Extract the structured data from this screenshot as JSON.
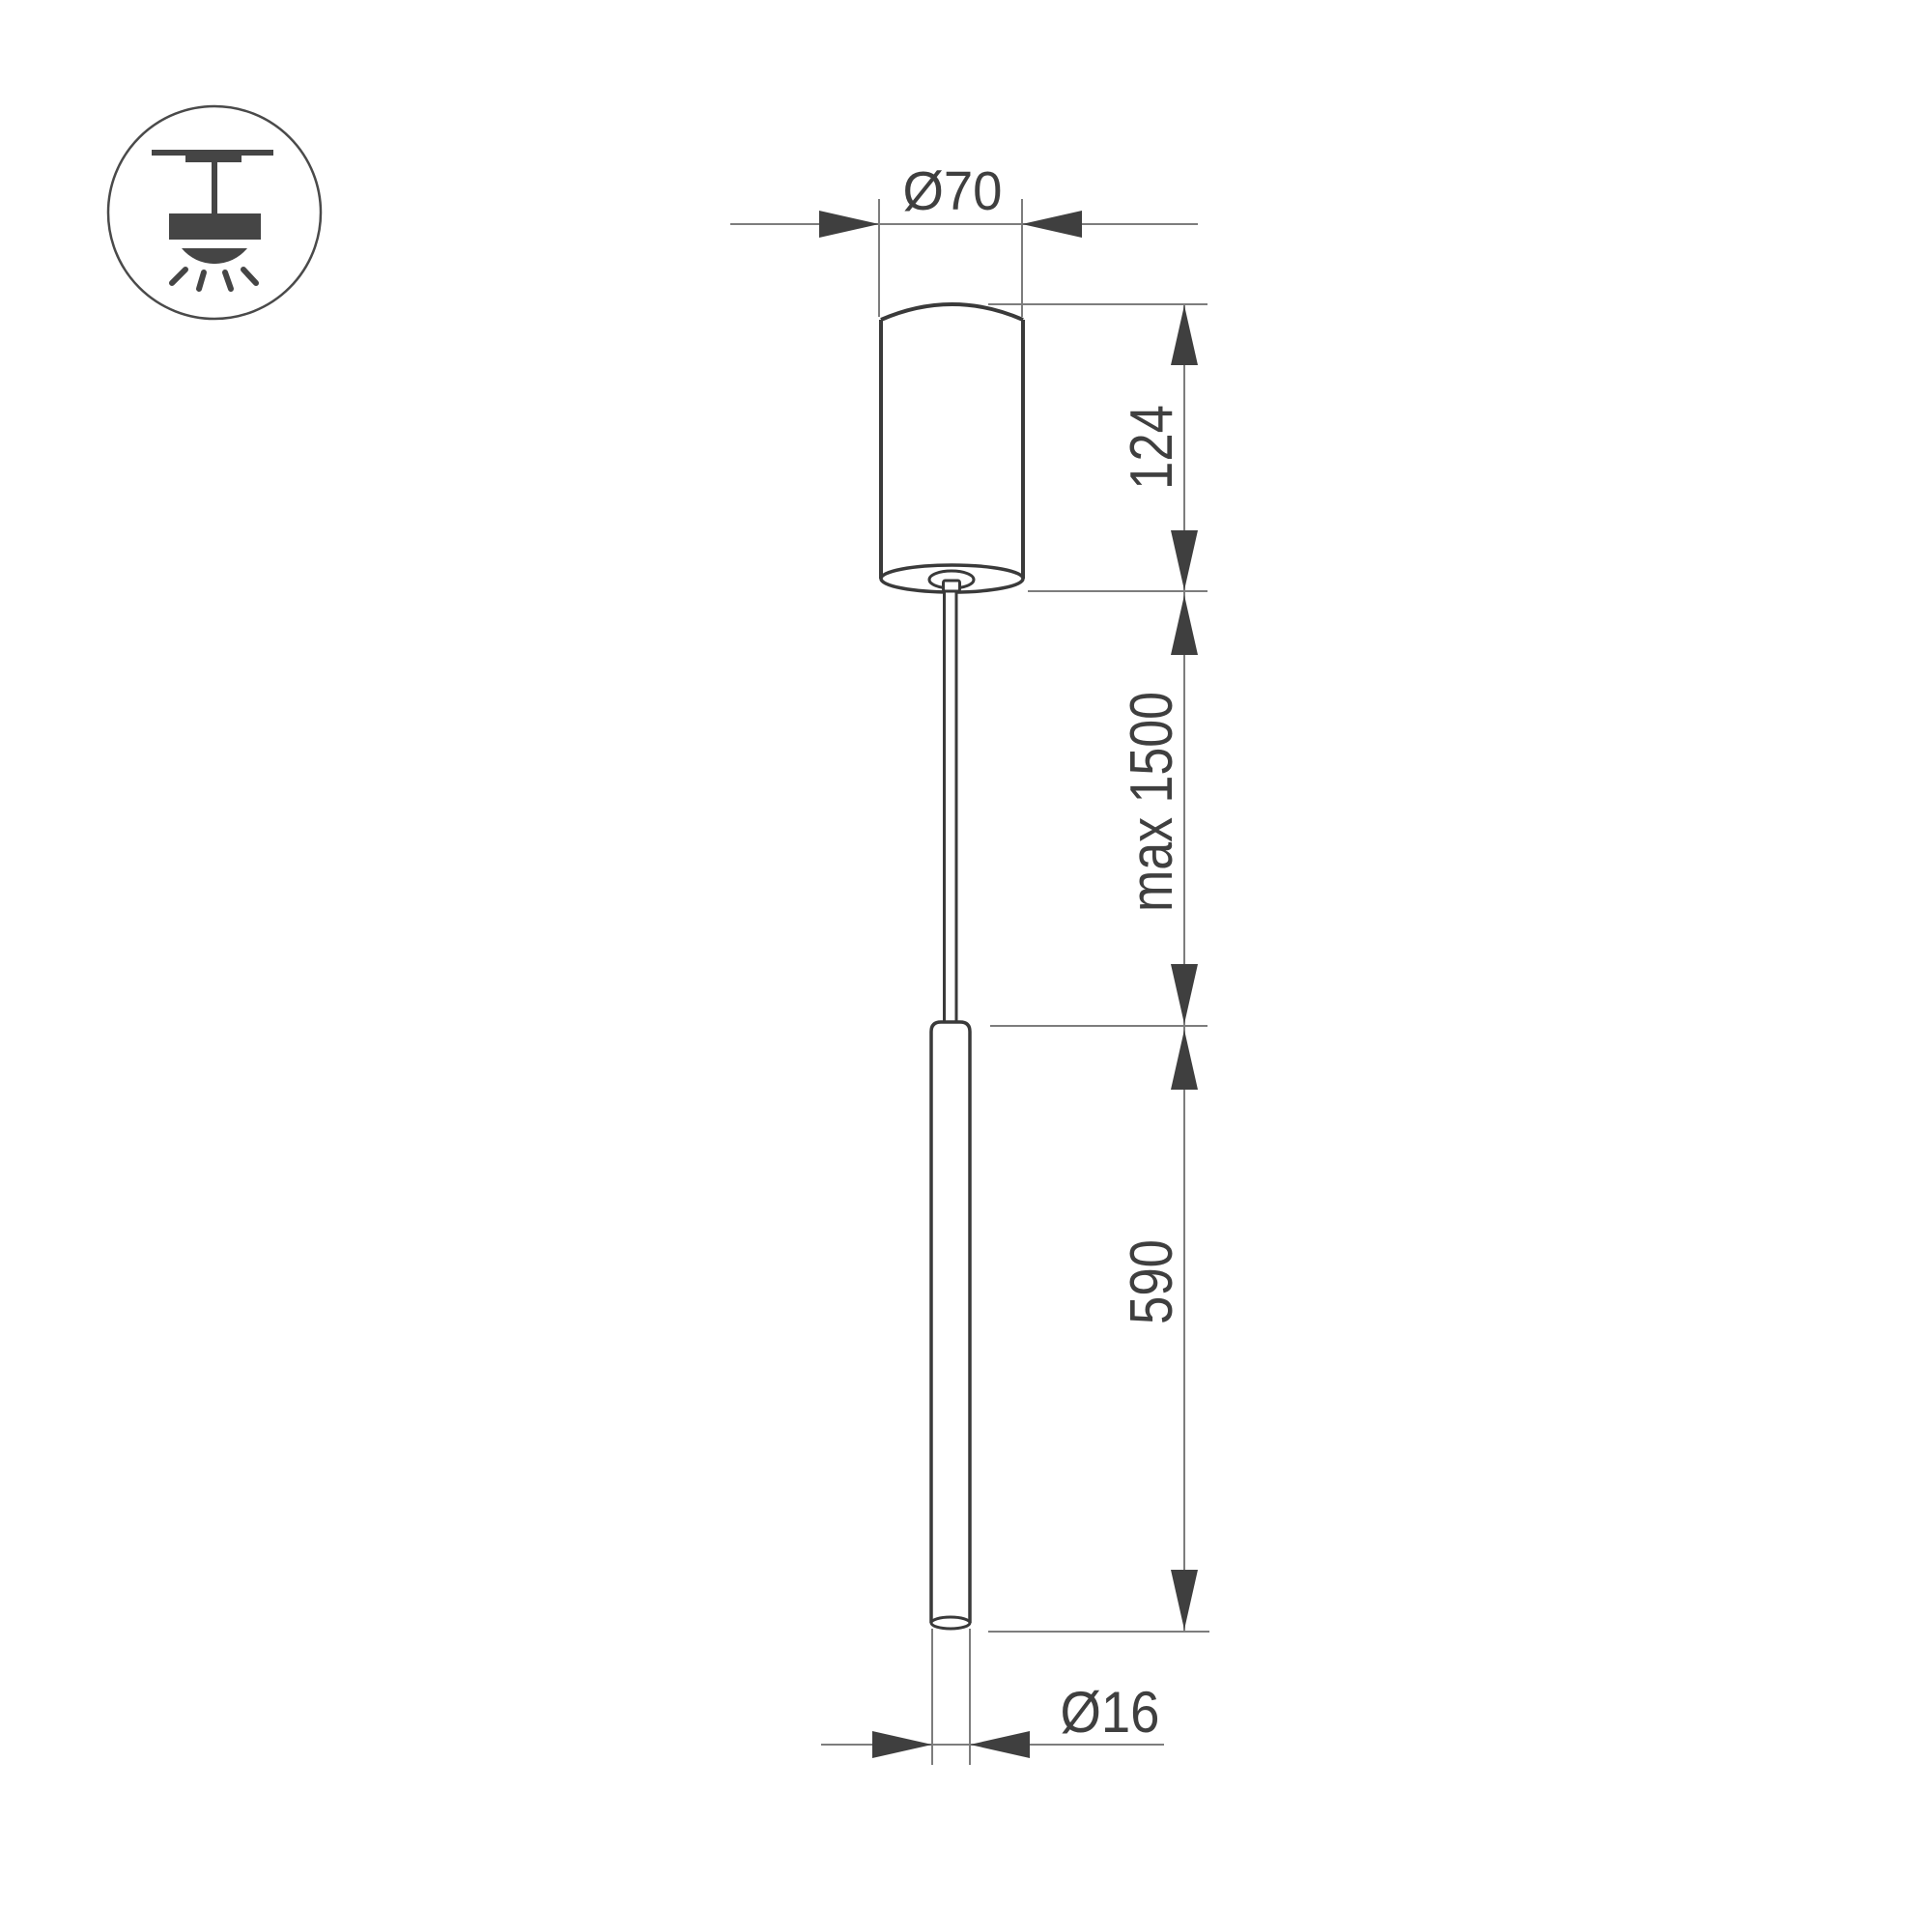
{
  "meta": {
    "kind": "technical dimension drawing",
    "subject": "pendant tube luminaire with ceiling canopy"
  },
  "icon": {
    "name": "ceiling-pendant-light-icon"
  },
  "labels": {
    "canopy_diameter": "Ø70",
    "canopy_height": "124",
    "suspension_length": "max 1500",
    "tube_length": "590",
    "tube_diameter": "Ø16"
  },
  "colors": {
    "bg": "#ffffff",
    "line": "#7d7d7d",
    "ink": "#3f3f3f",
    "outline": "#3a3a3a"
  }
}
